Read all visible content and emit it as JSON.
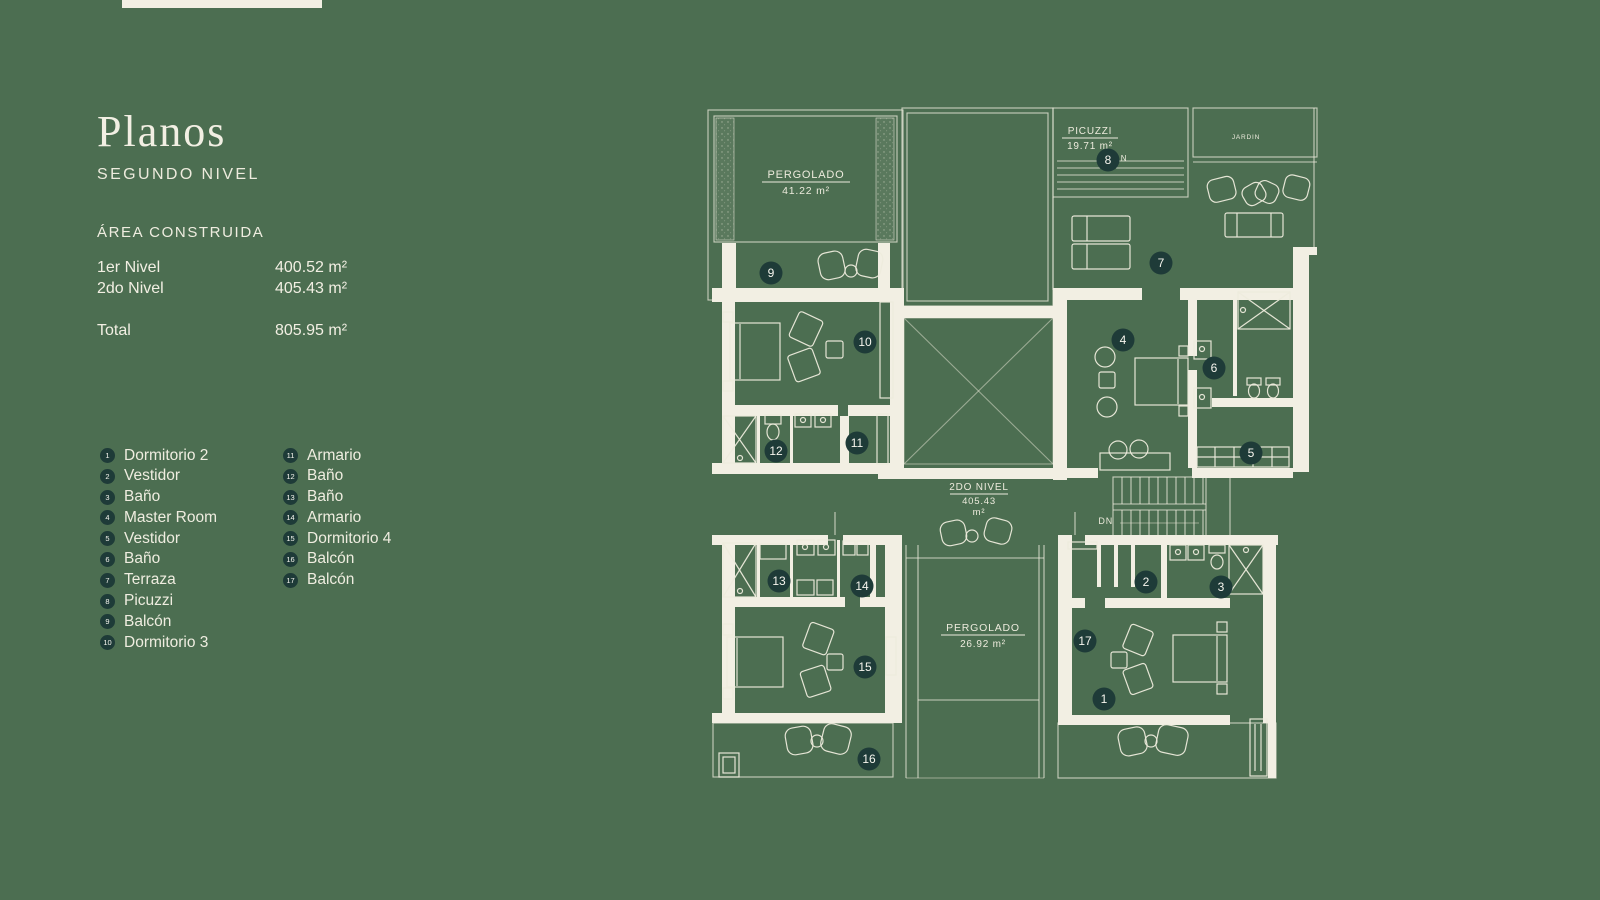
{
  "sidebar": {
    "title": "Planos",
    "subtitle": "SEGUNDO NIVEL",
    "area": {
      "heading": "ÁREA CONSTRUIDA",
      "rows": [
        {
          "label": "1er Nivel",
          "value": "400.52 m²"
        },
        {
          "label": "2do Nivel",
          "value": "405.43 m²"
        }
      ],
      "total": {
        "label": "Total",
        "value": "805.95 m²"
      }
    },
    "legend": {
      "col1": [
        {
          "num": "1",
          "label": "Dormitorio 2"
        },
        {
          "num": "2",
          "label": "Vestidor"
        },
        {
          "num": "3",
          "label": "Baño"
        },
        {
          "num": "4",
          "label": "Master Room"
        },
        {
          "num": "5",
          "label": "Vestidor"
        },
        {
          "num": "6",
          "label": "Baño"
        },
        {
          "num": "7",
          "label": "Terraza"
        },
        {
          "num": "8",
          "label": "Picuzzi"
        },
        {
          "num": "9",
          "label": "Balcón"
        },
        {
          "num": "10",
          "label": "Dormitorio 3"
        }
      ],
      "col2": [
        {
          "num": "11",
          "label": "Armario"
        },
        {
          "num": "12",
          "label": "Baño"
        },
        {
          "num": "13",
          "label": "Baño"
        },
        {
          "num": "14",
          "label": "Armario"
        },
        {
          "num": "15",
          "label": "Dormitorio 4"
        },
        {
          "num": "16",
          "label": "Balcón"
        },
        {
          "num": "17",
          "label": "Balcón"
        }
      ]
    }
  },
  "plan": {
    "labels": {
      "pergolado_top": {
        "title": "PERGOLADO",
        "area": "41.22 m²"
      },
      "picuzzi": {
        "title": "PICUZZI",
        "area": "19.71 m²",
        "north": "N"
      },
      "jardin": {
        "title": "JARDIN"
      },
      "nivel": {
        "title": "2DO NIVEL",
        "line2": "405.43",
        "line3": "m²"
      },
      "pergolado_bottom": {
        "title": "PERGOLADO",
        "area": "26.92 m²"
      },
      "stairs": {
        "dn": "DN"
      }
    },
    "markers": [
      {
        "num": "1"
      },
      {
        "num": "2"
      },
      {
        "num": "3"
      },
      {
        "num": "4"
      },
      {
        "num": "5"
      },
      {
        "num": "6"
      },
      {
        "num": "7"
      },
      {
        "num": "8"
      },
      {
        "num": "9"
      },
      {
        "num": "10"
      },
      {
        "num": "11"
      },
      {
        "num": "12"
      },
      {
        "num": "13"
      },
      {
        "num": "14"
      },
      {
        "num": "15"
      },
      {
        "num": "16"
      },
      {
        "num": "17"
      }
    ]
  },
  "colors": {
    "background": "#4C6E51",
    "wall": "#F2EFE3",
    "line": "#E9E7D8",
    "marker_bg": "#1E3B38",
    "text_light": "#F2EFE3"
  }
}
